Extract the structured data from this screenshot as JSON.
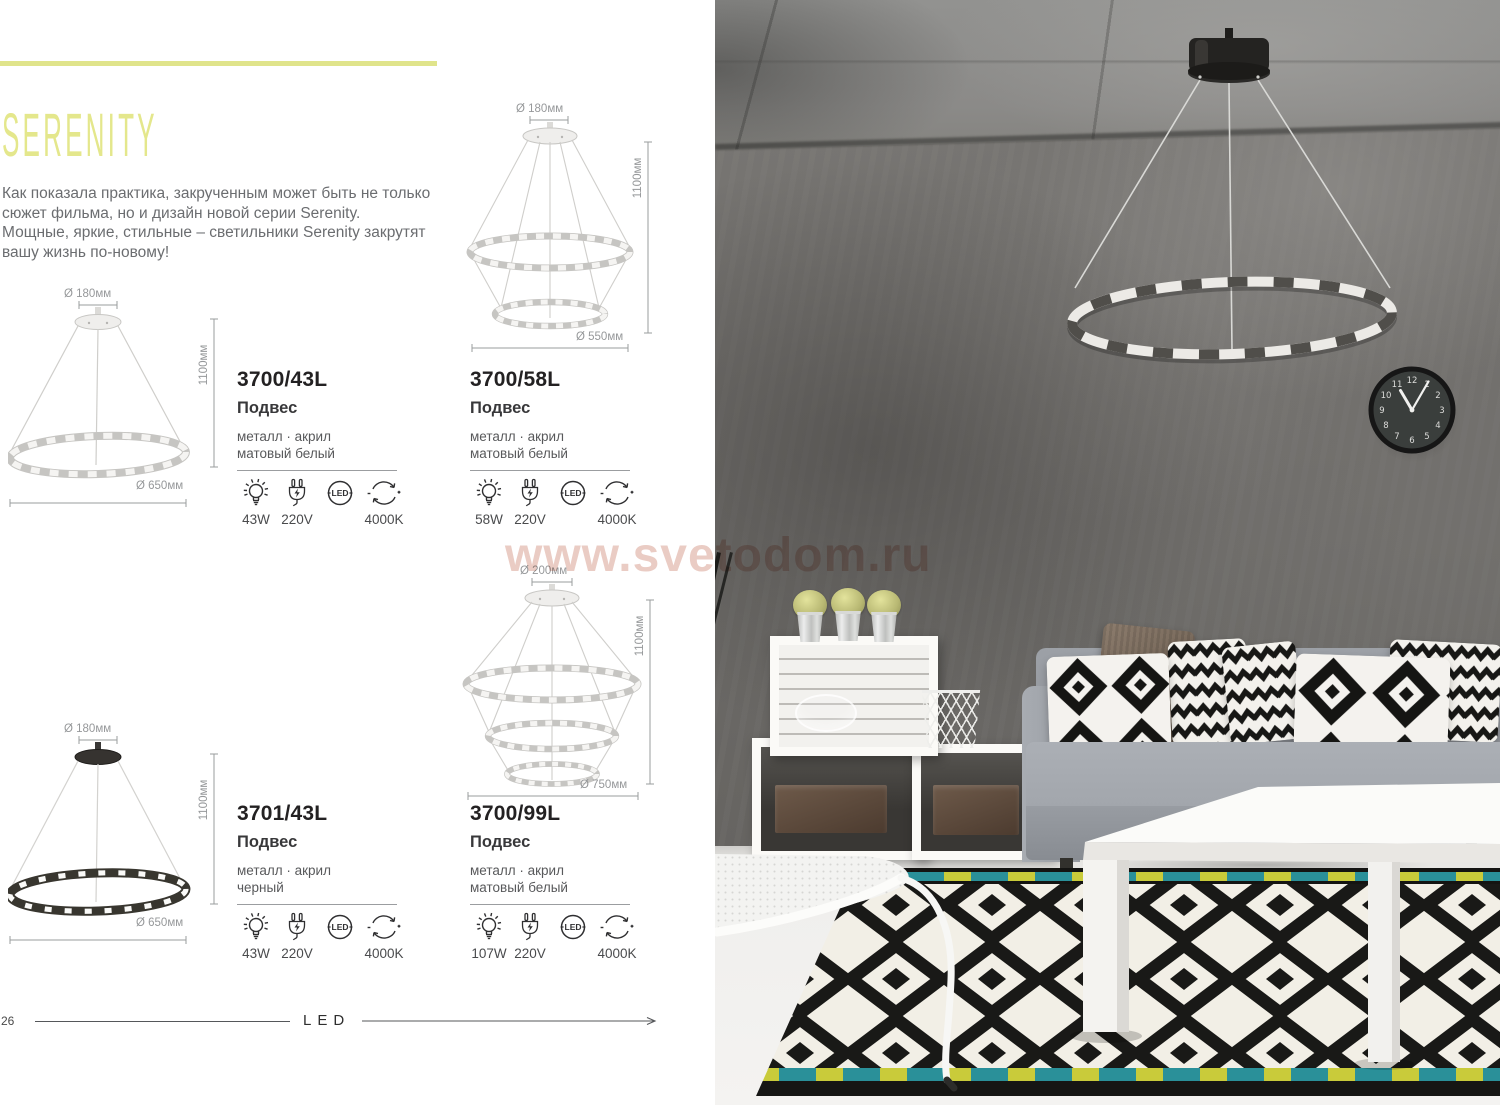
{
  "meta": {
    "accent_color": "#e0e48b",
    "watermark_color": "#d9a193",
    "rug_teal": "#2a9099",
    "rug_yellow": "#c9cb3a"
  },
  "catalog": {
    "series_title": "SERENITY",
    "intro_lines": [
      "Как показала практика, закрученным может быть не только",
      "сюжет фильма, но и дизайн новой серии Serenity.",
      "Мощные, яркие, стильные – светильники Serenity закрутят",
      "вашу жизнь по-новому!"
    ],
    "products": [
      {
        "code": "3700/43L",
        "type": "Подвес",
        "materials": "металл  ·  акрил",
        "finish": "матовый белый",
        "wattage": "43W",
        "voltage": "220V",
        "led": "LED",
        "color_temp": "4000K",
        "dim_top": "Ø 180мм",
        "dim_height": "1100мм",
        "dim_bottom": "Ø 650мм"
      },
      {
        "code": "3700/58L",
        "type": "Подвес",
        "materials": "металл  ·  акрил",
        "finish": "матовый белый",
        "wattage": "58W",
        "voltage": "220V",
        "led": "LED",
        "color_temp": "4000K",
        "dim_top": "Ø 180мм",
        "dim_height": "1100мм",
        "dim_bottom": "Ø 550мм"
      },
      {
        "code": "3701/43L",
        "type": "Подвес",
        "materials": "металл  ·  акрил",
        "finish": "черный",
        "wattage": "43W",
        "voltage": "220V",
        "led": "LED",
        "color_temp": "4000K",
        "dim_top": "Ø 180мм",
        "dim_height": "1100мм",
        "dim_bottom": "Ø 650мм"
      },
      {
        "code": "3700/99L",
        "type": "Подвес",
        "materials": "металл  ·  акрил",
        "finish": "матовый белый",
        "wattage": "107W",
        "voltage": "220V",
        "led": "LED",
        "color_temp": "4000K",
        "dim_top": "Ø 200мм",
        "dim_height": "1100мм",
        "dim_bottom": "Ø 750мм"
      }
    ],
    "icons": {
      "wattage": "bulb-icon",
      "voltage": "plug-icon",
      "source": "led-icon",
      "temperature": "color-temp-icon"
    },
    "footer": {
      "page_number": "26",
      "category_label": "LED"
    }
  },
  "watermark": {
    "text": "www.svetodom.ru"
  },
  "photo": {
    "clock": {
      "numerals": [
        "12",
        "1",
        "2",
        "3",
        "4",
        "5",
        "6",
        "7",
        "8",
        "9",
        "10",
        "11"
      ]
    }
  }
}
